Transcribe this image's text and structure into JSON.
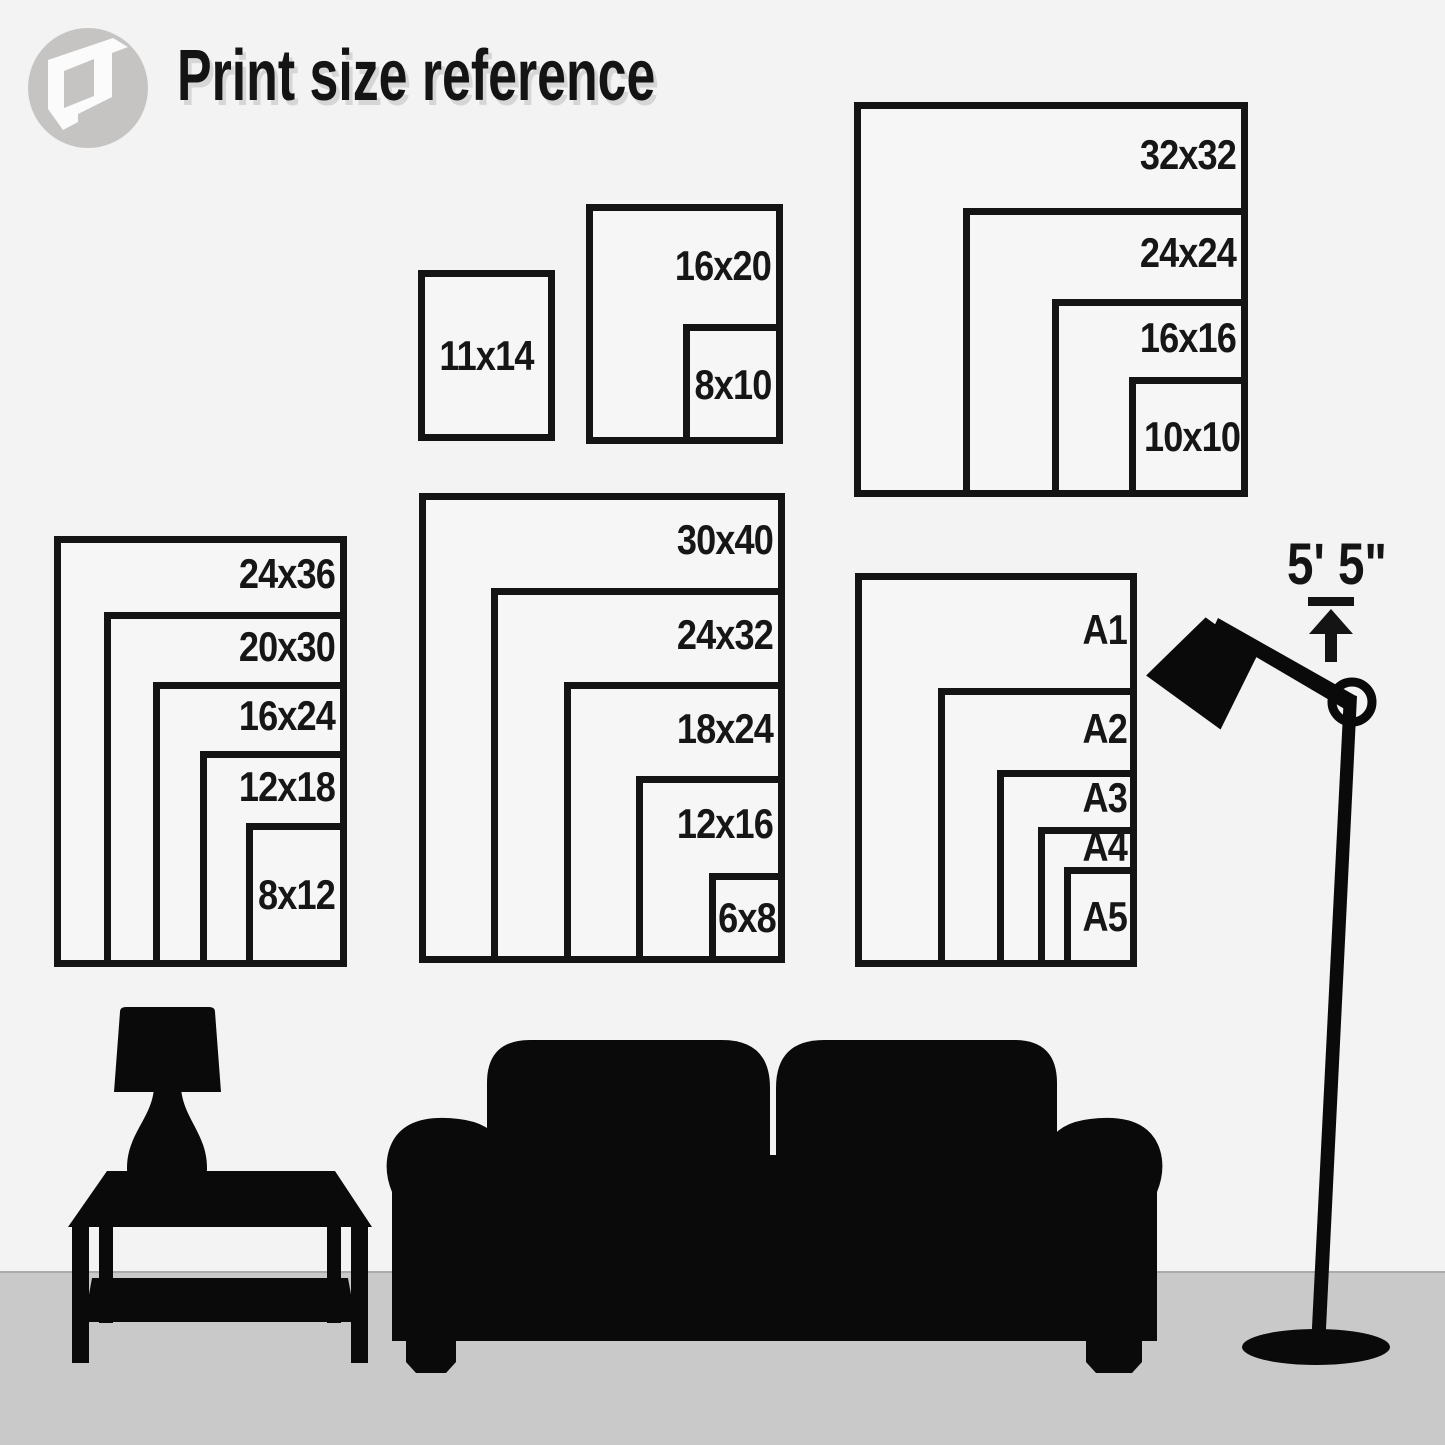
{
  "header": {
    "title": "Print size reference"
  },
  "logo": {
    "icon": "folded-paper-logo"
  },
  "size_groups": [
    {
      "id": "group-11x14",
      "sizes": [
        "11x14"
      ]
    },
    {
      "id": "group-16x20",
      "sizes": [
        "16x20",
        "8x10"
      ]
    },
    {
      "id": "group-squares",
      "sizes": [
        "32x32",
        "24x24",
        "16x16",
        "10x10"
      ]
    },
    {
      "id": "group-24x36",
      "sizes": [
        "24x36",
        "20x30",
        "16x24",
        "12x18",
        "8x12"
      ]
    },
    {
      "id": "group-30x40",
      "sizes": [
        "30x40",
        "24x32",
        "18x24",
        "12x16",
        "6x8"
      ]
    },
    {
      "id": "group-a-series",
      "sizes": [
        "A1",
        "A2",
        "A3",
        "A4",
        "A5"
      ]
    }
  ],
  "height_reference": {
    "label": "5' 5\"",
    "icon": "height-arrow-icon"
  },
  "scene": {
    "items": [
      "table-lamp",
      "side-table",
      "sofa",
      "floor-lamp"
    ]
  },
  "colors": {
    "wall": "#f3f3f3",
    "floor": "#c9c9c9",
    "box_line": "#141414",
    "label_text": "#161616",
    "silhouette": "#0a0a0a",
    "logo_gray": "#c6c4c2",
    "title_shadow": "#d6d6d6"
  }
}
